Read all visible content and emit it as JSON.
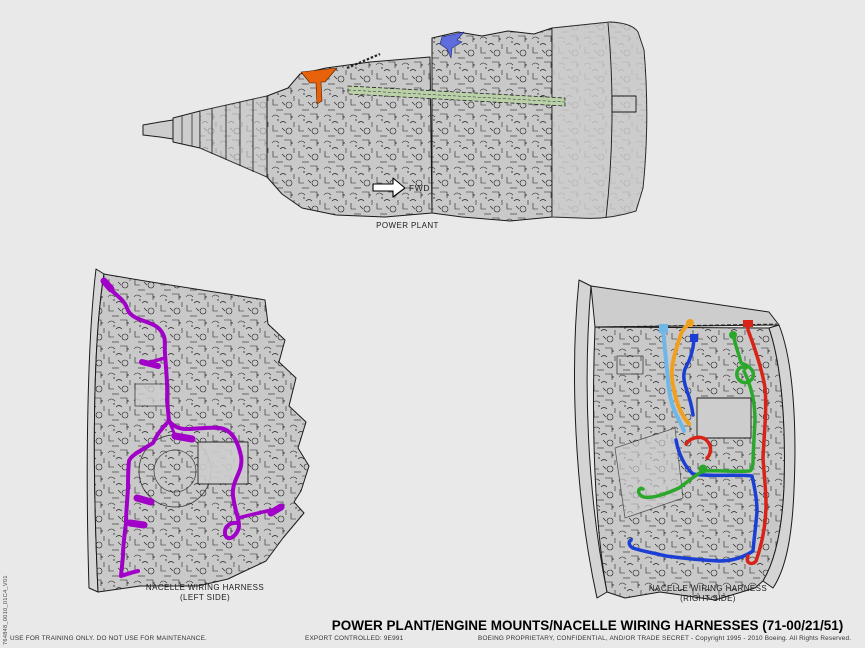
{
  "page": {
    "background": "#e9e9e9",
    "title": "POWER PLANT/ENGINE MOUNTS/NACELLE WIRING HARNESSES (71-00/21/51)",
    "footer": {
      "training_notice": "USE FOR TRAINING ONLY. DO NOT USE FOR MAINTENANCE.",
      "export_notice": "EXPORT CONTROLLED: 9E991",
      "proprietary_notice": "BOEING PROPRIETARY, CONFIDENTIAL, AND/OR TRADE SECRET - Copyright 1995 - 2010 Boeing. All Rights Reserved.",
      "figure_id": "764848_0010_01C4_V01"
    }
  },
  "diagrams": {
    "power_plant": {
      "caption": "POWER PLANT",
      "fwd_label": "FWD",
      "aft_mount_color": "#e8620c",
      "fwd_mount_color": "#5f6cdb",
      "harness_color": "#b9d0a9"
    },
    "left_nacelle": {
      "caption_line1": "NACELLE WIRING HARNESS",
      "caption_line2": "(LEFT SIDE)",
      "harness_color": "#a100c8"
    },
    "right_nacelle": {
      "caption_line1": "NACELLE WIRING HARNESS",
      "caption_line2": "(RIGHT SIDE)",
      "harness_colors": {
        "sky_blue": "#6fb7e8",
        "orange": "#f0a020",
        "blue": "#1b3fd4",
        "green": "#2ba82b",
        "red": "#d82418"
      }
    }
  }
}
